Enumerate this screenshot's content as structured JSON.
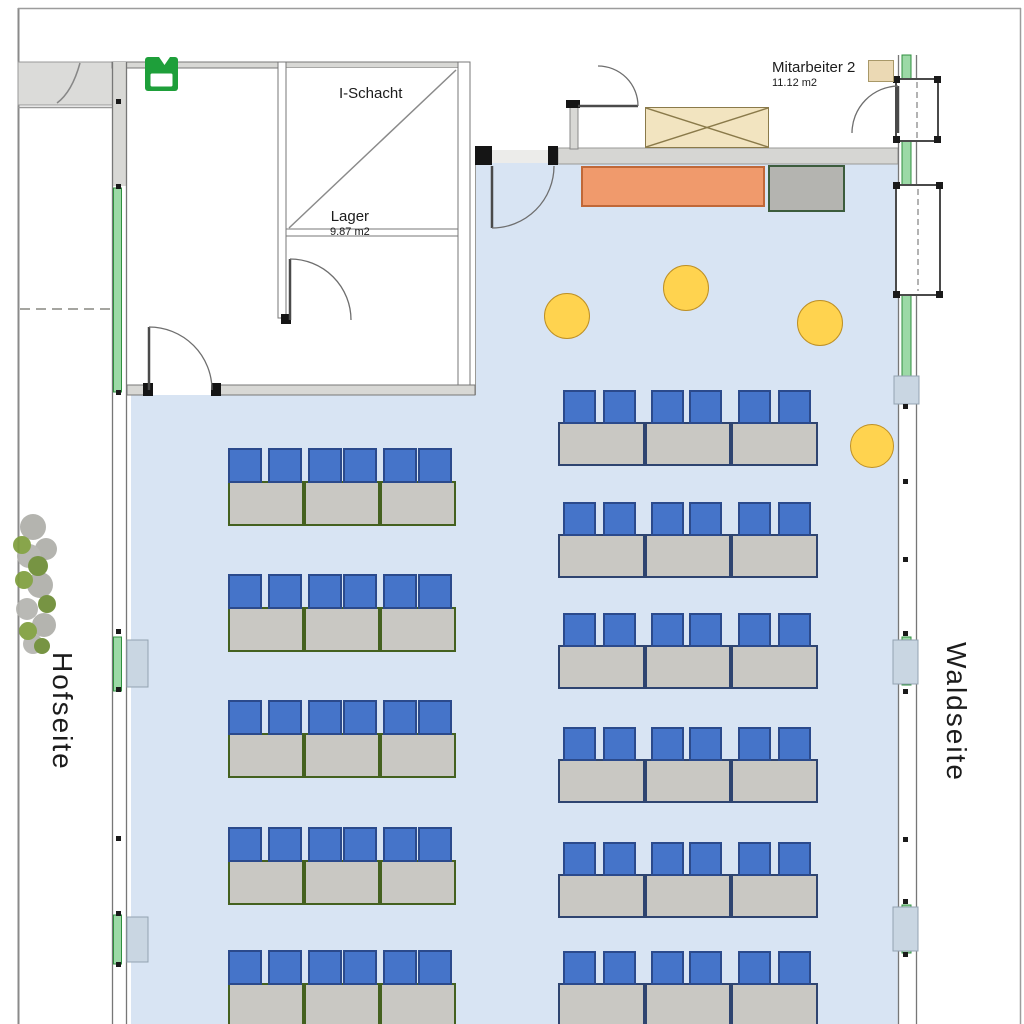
{
  "plan": {
    "labels": {
      "left_side": "Hofseite",
      "right_side": "Waldseite",
      "shaft_room": "I-Schacht",
      "storage_room": "Lager",
      "storage_area": "9.87 m2",
      "staff_room": "Mitarbeiter 2",
      "staff_area": "11.12 m2"
    },
    "colors": {
      "floor": "#D8E4F3",
      "chair_fill": "#4574C9",
      "chair_border": "#2B4A8C",
      "table_fill": "#C9C8C3",
      "stool_fill": "#FFD34F",
      "stool_border": "#BE9025",
      "sideboard_fill": "#F09A6C",
      "sideboard_border": "#C06838",
      "cabinet_fill": "#B4B4B0",
      "cabinet_border": "#3C5C3C",
      "wood_table_fill": "#F2E4C0",
      "wood_table_border": "#8A7A4A",
      "small_cabinet_fill": "#EBD9B4",
      "small_cabinet_border": "#A89868",
      "window_green": "#9CD9A6",
      "exit_green": "#1E9F3A"
    },
    "desk_columns": [
      {
        "id": "left-block",
        "x": 228,
        "group_width": 228,
        "table_count": 3,
        "table_height": 45,
        "chair_width": 34,
        "chair_height": 35,
        "chair_offsets": [
          0,
          40,
          80,
          115,
          155,
          190
        ],
        "table_border": "#44611F",
        "rows_y": [
          448,
          574,
          700,
          827,
          950
        ]
      },
      {
        "id": "right-block",
        "x": 558,
        "group_width": 260,
        "table_count": 3,
        "table_height": 44,
        "chair_width": 33,
        "chair_height": 34,
        "chair_offsets": [
          5,
          45,
          93,
          131,
          180,
          220
        ],
        "table_border": "#2E4470",
        "rows_y": [
          390,
          502,
          613,
          727,
          842,
          951
        ]
      }
    ],
    "stools": [
      {
        "cx": 567,
        "cy": 316,
        "r": 23
      },
      {
        "cx": 686,
        "cy": 288,
        "r": 23
      },
      {
        "cx": 820,
        "cy": 323,
        "r": 23
      },
      {
        "cx": 872,
        "cy": 446,
        "r": 22
      }
    ],
    "furniture": [
      {
        "type": "wood-table",
        "x": 645,
        "y": 107,
        "w": 124,
        "h": 41
      },
      {
        "type": "sideboard",
        "x": 581,
        "y": 166,
        "w": 184,
        "h": 41
      },
      {
        "type": "cabinet",
        "x": 768,
        "y": 165,
        "w": 77,
        "h": 47
      },
      {
        "type": "small-cabinet",
        "x": 868,
        "y": 60,
        "w": 26,
        "h": 22
      }
    ]
  }
}
